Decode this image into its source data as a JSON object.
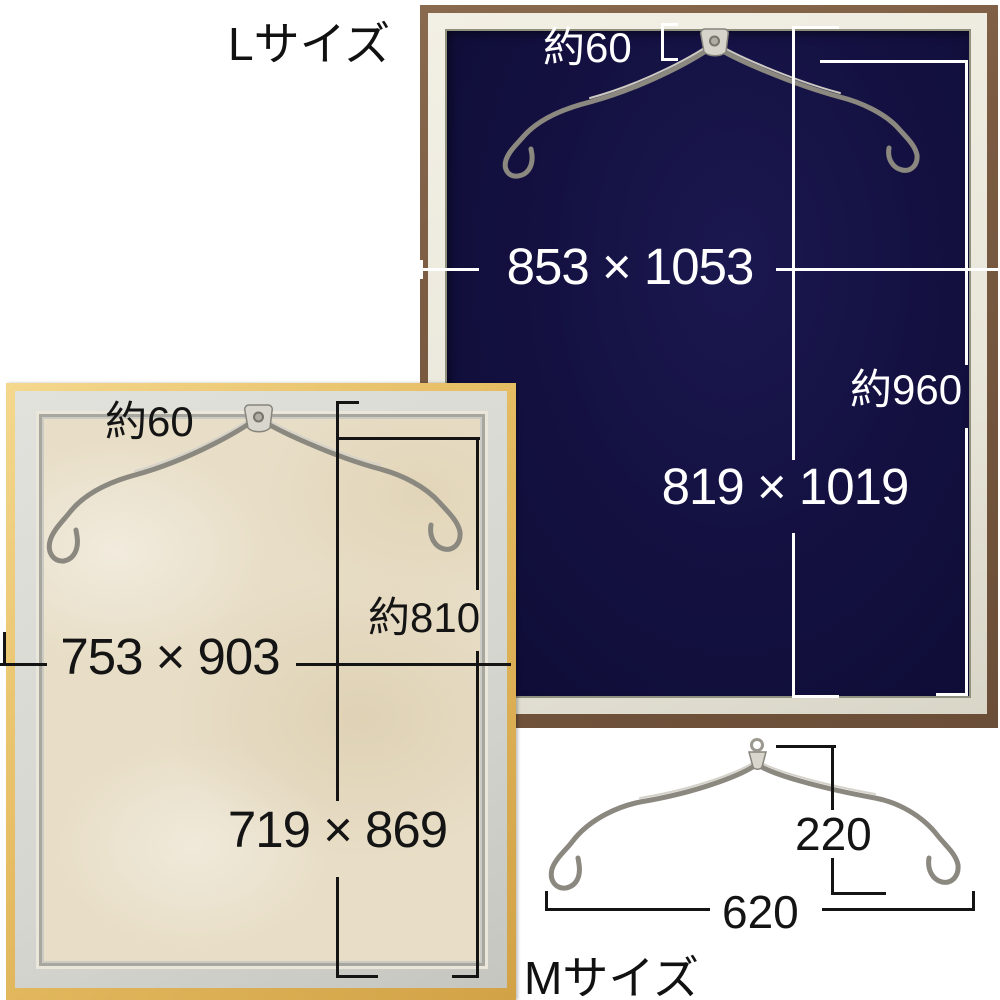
{
  "labels": {
    "l_size": "Lサイズ",
    "m_size": "Mサイズ"
  },
  "l_frame": {
    "hook_gap": "約60",
    "outer_dimensions": "853 × 1053",
    "hanging_height": "約960",
    "inner_dimensions": "819 × 1019"
  },
  "m_frame": {
    "hook_gap": "約60",
    "outer_dimensions": "753 × 903",
    "hanging_height": "約810",
    "inner_dimensions": "719 × 869"
  },
  "m_hanger": {
    "drop_height": "220",
    "width": "620"
  },
  "colors": {
    "l_frame_moulding": "#7a5b42",
    "l_frame_mat": "#141142",
    "m_frame_moulding": "#e5bc62",
    "m_frame_mat": "#e8dec7",
    "light_dimension_lines": "#ffffff",
    "dark_dimension_lines": "#141414",
    "wire": "#a09d95"
  }
}
